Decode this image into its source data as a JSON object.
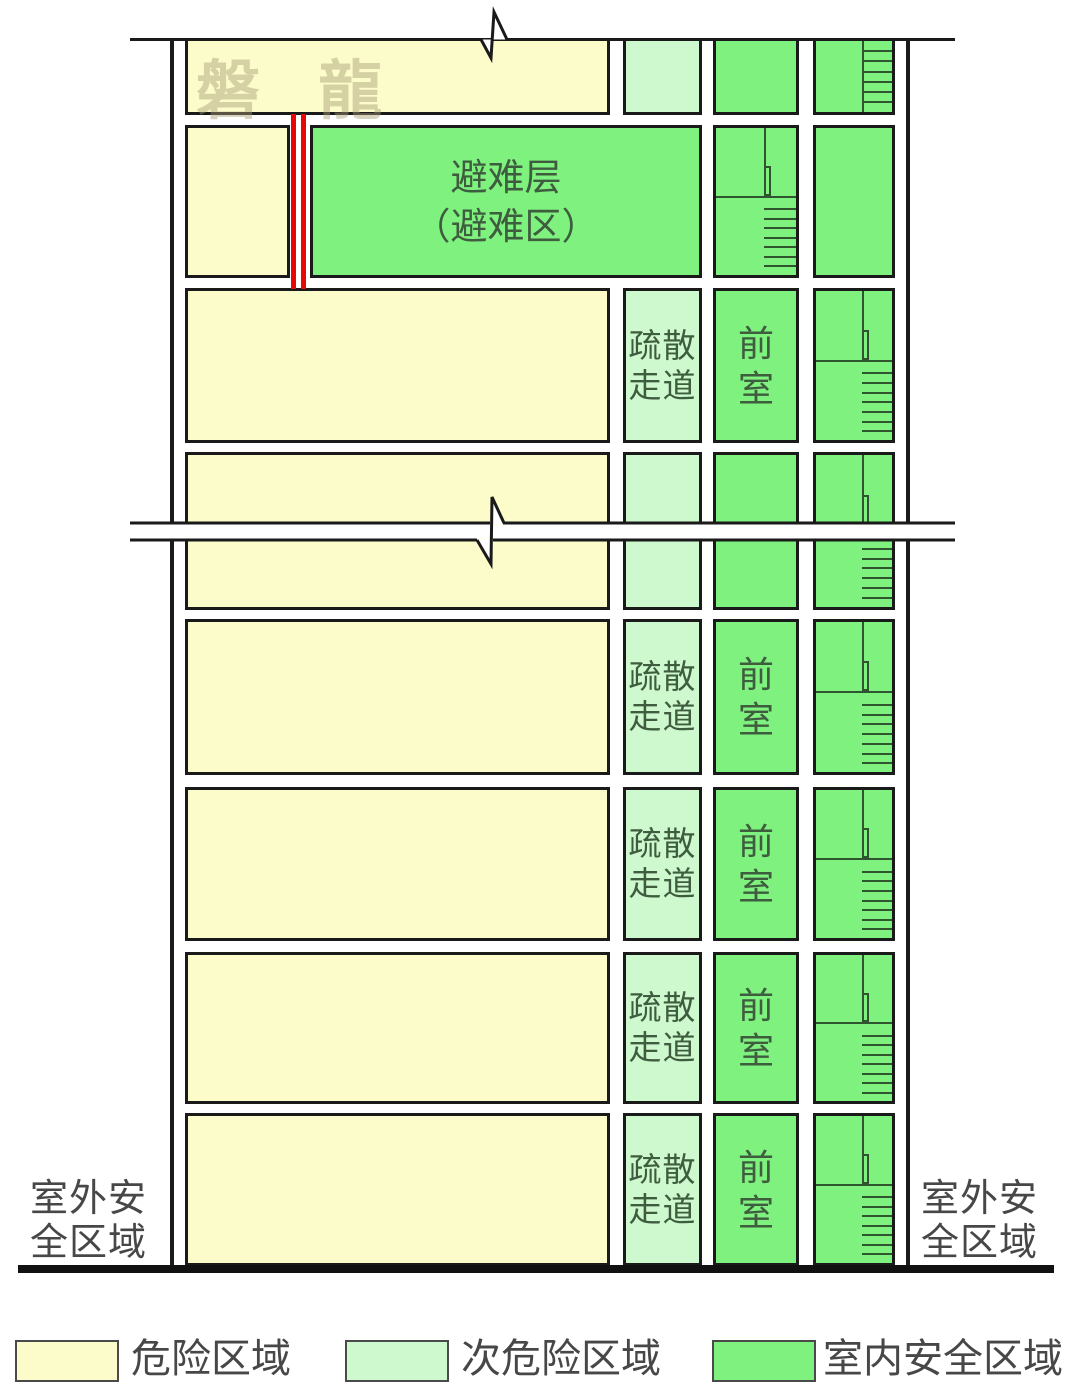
{
  "diagram": {
    "watermark": "磐 龍",
    "floors": [
      {
        "kind": "partial-top"
      },
      {
        "kind": "refuge",
        "label_lines": [
          "避难层",
          "（避难区）"
        ]
      },
      {
        "kind": "standard",
        "corridor_lines": [
          "疏散",
          "走道"
        ],
        "vestibule_lines": [
          "前",
          "室"
        ]
      },
      {
        "kind": "cut"
      },
      {
        "kind": "standard",
        "corridor_lines": [
          "疏散",
          "走道"
        ],
        "vestibule_lines": [
          "前",
          "室"
        ]
      },
      {
        "kind": "standard",
        "corridor_lines": [
          "疏散",
          "走道"
        ],
        "vestibule_lines": [
          "前",
          "室"
        ]
      },
      {
        "kind": "standard",
        "corridor_lines": [
          "疏散",
          "走道"
        ],
        "vestibule_lines": [
          "前",
          "室"
        ]
      },
      {
        "kind": "standard",
        "corridor_lines": [
          "疏散",
          "走道"
        ],
        "vestibule_lines": [
          "前",
          "室"
        ]
      }
    ],
    "outdoor_left_lines": [
      "室外安",
      "全区域"
    ],
    "outdoor_right_lines": [
      "室外安",
      "全区域"
    ]
  },
  "legend": {
    "items": [
      {
        "label": "危险区域",
        "color": "#FCFCCB"
      },
      {
        "label": "次危险区域",
        "color": "#CEF8CE"
      },
      {
        "label": "室内安全区域",
        "color": "#7EF17E"
      }
    ]
  },
  "colors": {
    "hazard_yellow": "#FCFCCB",
    "sub_hazard_green": "#CEF8CE",
    "indoor_safe_green": "#7EF17E",
    "fire_wall_red": "#E90606",
    "outline_black": "#1A1A1A",
    "label_green": "#3E5C3E",
    "label_gray": "#474747"
  }
}
